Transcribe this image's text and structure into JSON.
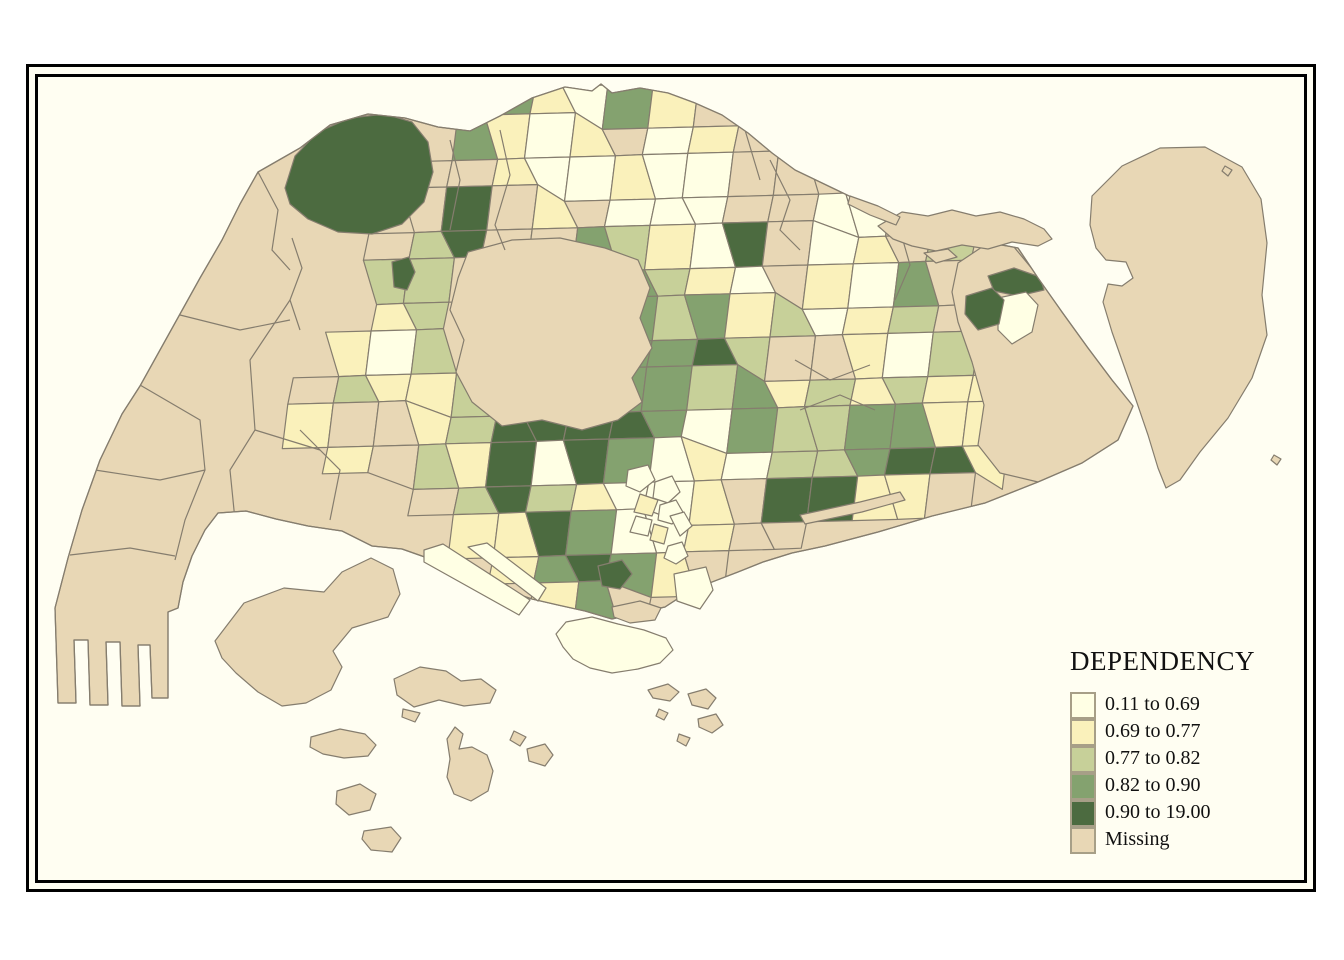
{
  "frame": {
    "page_bg": "#ffffff",
    "border_color": "#000000",
    "sea_color": "#FFFEF2"
  },
  "legend": {
    "title": "DEPENDENCY",
    "swatch_border": "#A79F87",
    "items": [
      {
        "label": "0.11 to 0.69",
        "class": "c1"
      },
      {
        "label": "0.69 to 0.77",
        "class": "c2"
      },
      {
        "label": "0.77 to 0.82",
        "class": "c3"
      },
      {
        "label": "0.82 to 0.90",
        "class": "c4"
      },
      {
        "label": "0.90 to 19.00",
        "class": "c5"
      },
      {
        "label": "Missing",
        "class": "m"
      }
    ]
  },
  "map": {
    "stroke": "#857D6E",
    "classes": {
      "c1": "#FFFFE4",
      "c2": "#FAF1BB",
      "c3": "#C7D099",
      "c4": "#84A26F",
      "c5": "#4C6B40",
      "m": "#E8D7B5"
    },
    "main_island": "258,172 300,148 330,125 368,114 405,118 438,127 470,131 500,116 532,98 565,87 592,91 601,84 612,93 640,88 668,93 695,103 722,115 748,133 772,153 795,170 820,182 845,194 872,207 900,221 932,231 962,238 992,243 1018,248 1038,278 1062,312 1088,348 1112,380 1133,406 1118,440 1082,463 1038,482 985,503 932,516 878,532 825,546 792,553 763,562 738,572 712,582 688,592 665,607 638,613 612,619 585,611 558,605 532,599 508,591 472,576 436,561 402,549 372,546 342,531 308,526 276,519 246,511 218,513 205,530 192,556 183,582 178,608 168,612 168,698 152,698 150,645 138,645 140,706 122,706 120,642 106,642 108,705 90,705 88,640 74,640 76,703 58,703 55,608 68,558 82,510 100,460 122,414 140,386 160,350 180,314 200,278 222,240 240,204",
    "grid": {
      "x0": 290,
      "y0": 85,
      "dx": 40,
      "dy": 36,
      "cells": [
        [
          5,
          0,
          "c4"
        ],
        [
          6,
          0,
          "c2"
        ],
        [
          7,
          0,
          "c1"
        ],
        [
          8,
          0,
          "c4"
        ],
        [
          9,
          0,
          "c2"
        ],
        [
          10,
          0,
          "m"
        ],
        [
          4,
          1,
          "c4"
        ],
        [
          5,
          1,
          "c2"
        ],
        [
          6,
          1,
          "c1"
        ],
        [
          7,
          1,
          "c2"
        ],
        [
          8,
          1,
          "m"
        ],
        [
          9,
          1,
          "c1"
        ],
        [
          10,
          1,
          "c2"
        ],
        [
          11,
          1,
          "m"
        ],
        [
          3,
          2,
          "m"
        ],
        [
          4,
          2,
          "m"
        ],
        [
          5,
          2,
          "c2"
        ],
        [
          6,
          2,
          "c1"
        ],
        [
          7,
          2,
          "c1"
        ],
        [
          8,
          2,
          "c2"
        ],
        [
          9,
          2,
          "c1"
        ],
        [
          10,
          2,
          "c1"
        ],
        [
          11,
          2,
          "m"
        ],
        [
          12,
          2,
          "m"
        ],
        [
          3,
          3,
          "m"
        ],
        [
          4,
          3,
          "c5"
        ],
        [
          5,
          3,
          "m"
        ],
        [
          6,
          3,
          "c2"
        ],
        [
          7,
          3,
          "m"
        ],
        [
          8,
          3,
          "c1"
        ],
        [
          9,
          3,
          "c1"
        ],
        [
          10,
          3,
          "c1"
        ],
        [
          11,
          3,
          "m"
        ],
        [
          12,
          3,
          "m"
        ],
        [
          13,
          3,
          "c1"
        ],
        [
          14,
          3,
          "c1"
        ],
        [
          15,
          3,
          "m"
        ],
        [
          2,
          4,
          "m"
        ],
        [
          3,
          4,
          "c3"
        ],
        [
          4,
          4,
          "c5"
        ],
        [
          5,
          4,
          "m"
        ],
        [
          6,
          4,
          "m"
        ],
        [
          7,
          4,
          "c4"
        ],
        [
          8,
          4,
          "c3"
        ],
        [
          9,
          4,
          "c2"
        ],
        [
          10,
          4,
          "c1"
        ],
        [
          11,
          4,
          "c5"
        ],
        [
          12,
          4,
          "m"
        ],
        [
          13,
          4,
          "c1"
        ],
        [
          14,
          4,
          "c2"
        ],
        [
          15,
          4,
          "m"
        ],
        [
          16,
          4,
          "c3"
        ],
        [
          2,
          5,
          "c3"
        ],
        [
          3,
          5,
          "c3"
        ],
        [
          4,
          5,
          "m"
        ],
        [
          7,
          5,
          "c4"
        ],
        [
          8,
          5,
          "c4"
        ],
        [
          9,
          5,
          "c3"
        ],
        [
          10,
          5,
          "c2"
        ],
        [
          11,
          5,
          "c1"
        ],
        [
          12,
          5,
          "m"
        ],
        [
          13,
          5,
          "c2"
        ],
        [
          14,
          5,
          "c1"
        ],
        [
          15,
          5,
          "c4"
        ],
        [
          16,
          5,
          "m"
        ],
        [
          2,
          6,
          "c2"
        ],
        [
          3,
          6,
          "c3"
        ],
        [
          8,
          6,
          "c4"
        ],
        [
          9,
          6,
          "c3"
        ],
        [
          10,
          6,
          "c4"
        ],
        [
          11,
          6,
          "c2"
        ],
        [
          12,
          6,
          "c3"
        ],
        [
          13,
          6,
          "c1"
        ],
        [
          14,
          6,
          "c2"
        ],
        [
          15,
          6,
          "c3"
        ],
        [
          16,
          6,
          "m"
        ],
        [
          1,
          7,
          "c2"
        ],
        [
          2,
          7,
          "c1"
        ],
        [
          3,
          7,
          "c3"
        ],
        [
          8,
          7,
          "c4"
        ],
        [
          9,
          7,
          "c4"
        ],
        [
          10,
          7,
          "c5"
        ],
        [
          11,
          7,
          "c3"
        ],
        [
          12,
          7,
          "m"
        ],
        [
          13,
          7,
          "m"
        ],
        [
          14,
          7,
          "c2"
        ],
        [
          15,
          7,
          "c1"
        ],
        [
          16,
          7,
          "c3"
        ],
        [
          0,
          8,
          "m"
        ],
        [
          1,
          8,
          "c3"
        ],
        [
          2,
          8,
          "c2"
        ],
        [
          3,
          8,
          "c2"
        ],
        [
          4,
          8,
          "c3"
        ],
        [
          7,
          8,
          "c4"
        ],
        [
          8,
          8,
          "c4"
        ],
        [
          9,
          8,
          "c4"
        ],
        [
          10,
          8,
          "c3"
        ],
        [
          11,
          8,
          "c4"
        ],
        [
          12,
          8,
          "c2"
        ],
        [
          13,
          8,
          "c3"
        ],
        [
          14,
          8,
          "c2"
        ],
        [
          15,
          8,
          "c3"
        ],
        [
          16,
          8,
          "c2"
        ],
        [
          17,
          8,
          "c2"
        ],
        [
          0,
          9,
          "c2"
        ],
        [
          1,
          9,
          "m"
        ],
        [
          2,
          9,
          "m"
        ],
        [
          3,
          9,
          "c2"
        ],
        [
          4,
          9,
          "c3"
        ],
        [
          5,
          9,
          "c5"
        ],
        [
          6,
          9,
          "c5"
        ],
        [
          7,
          9,
          "c5"
        ],
        [
          8,
          9,
          "c5"
        ],
        [
          9,
          9,
          "c4"
        ],
        [
          10,
          9,
          "c1"
        ],
        [
          11,
          9,
          "c4"
        ],
        [
          12,
          9,
          "c3"
        ],
        [
          13,
          9,
          "c3"
        ],
        [
          14,
          9,
          "c4"
        ],
        [
          15,
          9,
          "c4"
        ],
        [
          16,
          9,
          "c2"
        ],
        [
          17,
          9,
          "c2"
        ],
        [
          1,
          10,
          "c2"
        ],
        [
          2,
          10,
          "m"
        ],
        [
          3,
          10,
          "c3"
        ],
        [
          4,
          10,
          "c2"
        ],
        [
          5,
          10,
          "c5"
        ],
        [
          6,
          10,
          "c1"
        ],
        [
          7,
          10,
          "c5"
        ],
        [
          8,
          10,
          "c4"
        ],
        [
          9,
          10,
          "c1"
        ],
        [
          10,
          10,
          "c2"
        ],
        [
          11,
          10,
          "c1"
        ],
        [
          12,
          10,
          "c3"
        ],
        [
          13,
          10,
          "c3"
        ],
        [
          14,
          10,
          "c4"
        ],
        [
          15,
          10,
          "c5"
        ],
        [
          16,
          10,
          "c5"
        ],
        [
          17,
          10,
          "c2"
        ],
        [
          3,
          11,
          "m"
        ],
        [
          4,
          11,
          "c3"
        ],
        [
          5,
          11,
          "c5"
        ],
        [
          6,
          11,
          "c3"
        ],
        [
          7,
          11,
          "c2"
        ],
        [
          8,
          11,
          "c1"
        ],
        [
          9,
          11,
          "c1"
        ],
        [
          10,
          11,
          "c2"
        ],
        [
          11,
          11,
          "m"
        ],
        [
          12,
          11,
          "c5"
        ],
        [
          13,
          11,
          "c5"
        ],
        [
          14,
          11,
          "c2"
        ],
        [
          15,
          11,
          "c2"
        ],
        [
          16,
          11,
          "m"
        ],
        [
          4,
          12,
          "c2"
        ],
        [
          5,
          12,
          "c2"
        ],
        [
          6,
          12,
          "c5"
        ],
        [
          7,
          12,
          "c4"
        ],
        [
          8,
          12,
          "c1"
        ],
        [
          9,
          12,
          "c1"
        ],
        [
          10,
          12,
          "c2"
        ],
        [
          11,
          12,
          "m"
        ],
        [
          12,
          12,
          "m"
        ],
        [
          5,
          13,
          "c2"
        ],
        [
          6,
          13,
          "c4"
        ],
        [
          7,
          13,
          "c5"
        ],
        [
          8,
          13,
          "c4"
        ],
        [
          9,
          13,
          "c2"
        ],
        [
          10,
          13,
          "m"
        ],
        [
          6,
          14,
          "c2"
        ],
        [
          7,
          14,
          "c4"
        ],
        [
          8,
          14,
          "m"
        ]
      ]
    },
    "bigzones": [
      {
        "name": "western-catchment",
        "class": "c5",
        "points": "285,188 295,156 318,132 350,118 385,114 412,122 428,142 433,172 424,202 402,224 372,234 338,232 308,219 290,204"
      },
      {
        "name": "central-catchment",
        "class": "m",
        "points": "468,252 512,240 560,238 605,248 638,260 650,288 640,318 652,348 632,378 642,402 618,420 582,430 542,420 502,426 472,402 456,372 464,340 450,310 458,278"
      },
      {
        "name": "changi",
        "class": "m",
        "points": "988,243 1014,247 1038,276 1062,312 1088,348 1112,380 1134,406 1118,440 1082,463 1038,482 1000,473 978,445 984,405 972,362 958,322 952,292 958,263"
      }
    ],
    "details": [
      {
        "name": "changi-dark-sliver",
        "class": "c5",
        "points": "988,276 1014,268 1040,277 1044,290 1018,296 994,291"
      },
      {
        "name": "changi-white",
        "class": "c1",
        "points": "998,298 1026,292 1038,305 1032,332 1012,344 998,330"
      },
      {
        "name": "pasir-ris-dark",
        "class": "c5",
        "points": "966,296 992,288 1004,300 999,324 978,330 965,314"
      },
      {
        "name": "mandai-dark-sliver",
        "class": "c5",
        "points": "392,262 409,257 415,272 407,290 394,287"
      },
      {
        "name": "cbd-sub-1",
        "class": "c1",
        "points": "628,470 648,465 655,480 640,492 626,486"
      },
      {
        "name": "cbd-sub-2",
        "class": "c1",
        "points": "655,482 672,476 680,492 668,503 653,498"
      },
      {
        "name": "cbd-sub-3",
        "class": "c2",
        "points": "640,494 658,500 652,516 634,512"
      },
      {
        "name": "cbd-sub-4",
        "class": "c1",
        "points": "660,505 676,500 684,514 672,524 658,520"
      },
      {
        "name": "cbd-sub-5",
        "class": "c1",
        "points": "636,516 652,520 648,536 630,532"
      },
      {
        "name": "cbd-sub-6",
        "class": "c2",
        "points": "654,524 668,528 664,544 650,540"
      },
      {
        "name": "cbd-sub-7",
        "class": "c1",
        "points": "670,516 684,512 692,526 680,536"
      },
      {
        "name": "cbd-sub-8",
        "class": "c1",
        "points": "668,546 682,542 688,556 676,564 664,558"
      },
      {
        "name": "telok-blangah-dark",
        "class": "c5",
        "points": "598,566 622,560 632,574 620,589 602,586"
      },
      {
        "name": "marine-parade-tan",
        "class": "m",
        "points": "800,515 860,502 900,492 905,500 862,512 805,524"
      }
    ],
    "lines": [
      "140,385 200,420 205,470 185,520 175,560",
      "95,470 160,480 205,470",
      "70,555 130,548 175,556",
      "258,172 278,210 272,250 290,270",
      "292,238 302,268 290,300 300,330",
      "290,300 250,360 255,430 230,470 235,520",
      "180,315 240,330 290,320",
      "300,430 340,470 330,520",
      "255,430 320,450",
      "450,140 460,180 450,230",
      "500,130 510,175 495,225 505,250",
      "770,160 790,200 780,230 800,250",
      "745,130 760,180",
      "900,230 910,265 895,300",
      "795,360 830,380 870,365",
      "800,410 840,395 875,410"
    ],
    "islands": [
      {
        "name": "pulau-tekong",
        "class": "m",
        "points": "1092,196 1122,166 1160,148 1205,147 1242,167 1261,199 1267,243 1262,295 1267,335 1252,378 1228,418 1200,452 1180,480 1166,488 1158,468 1148,435 1136,400 1124,366 1112,332 1103,302 1108,284 1122,286 1133,278 1126,262 1106,260 1096,248 1090,225"
      },
      {
        "name": "pulau-ubin",
        "class": "m",
        "points": "878,226 902,212 928,216 952,210 976,216 1000,212 1024,219 1044,229 1052,239 1038,246 1012,242 988,249 962,245 936,251 912,246 893,239"
      },
      {
        "name": "ubin-islet",
        "class": "m",
        "points": "924,253 948,249 957,257 936,263"
      },
      {
        "name": "coney-island",
        "class": "m",
        "points": "850,196 878,206 900,217 896,225 870,215 848,204"
      },
      {
        "name": "sentosa",
        "class": "c1",
        "points": "566,622 592,617 618,624 644,630 666,638 673,650 660,663 638,669 612,673 590,668 573,659 563,647 556,634"
      },
      {
        "name": "pulau-brani",
        "class": "m",
        "points": "612,607 640,601 661,608 655,620 630,623 614,617"
      },
      {
        "name": "pulau-bukom",
        "class": "m",
        "points": "394,679 420,667 446,671 461,681 481,679 496,690 490,703 464,706 439,700 414,707 397,695"
      },
      {
        "name": "bukom-islet",
        "class": "m",
        "points": "403,709 420,713 415,722 402,717"
      },
      {
        "name": "pulau-semakau",
        "class": "m",
        "points": "447,739 455,727 463,734 459,749 472,747 487,755 493,771 488,791 471,801 454,794 447,777 450,759"
      },
      {
        "name": "pulau-jong",
        "class": "m",
        "points": "514,731 526,737 520,746 510,740"
      },
      {
        "name": "pulau-sebarok",
        "class": "m",
        "points": "527,749 545,744 553,755 545,766 529,761"
      },
      {
        "name": "pulau-sudong",
        "class": "m",
        "points": "311,737 340,729 365,734 376,745 368,756 344,758 323,754 310,747"
      },
      {
        "name": "pulau-pawai",
        "class": "m",
        "points": "337,791 360,784 376,794 370,810 349,815 336,804"
      },
      {
        "name": "pulau-senang",
        "class": "m",
        "points": "364,831 391,827 401,838 392,852 371,850 362,839"
      },
      {
        "name": "st-johns-island",
        "class": "m",
        "points": "648,690 668,684 679,692 670,701 653,698"
      },
      {
        "name": "lazarus-island",
        "class": "m",
        "points": "688,694 706,689 716,698 708,709 692,705"
      },
      {
        "name": "kusu-island",
        "class": "m",
        "points": "698,719 716,714 723,725 712,733 699,727"
      },
      {
        "name": "islet-south-1",
        "class": "m",
        "points": "659,709 668,713 664,720 656,716"
      },
      {
        "name": "islet-south-2",
        "class": "m",
        "points": "679,734 690,738 686,746 677,741"
      },
      {
        "name": "tekong-islet",
        "class": "m",
        "points": "1225,166 1232,170 1228,176 1222,171"
      },
      {
        "name": "changi-islet",
        "class": "m",
        "points": "1274,455 1281,459 1277,465 1271,460"
      },
      {
        "name": "jurong-island",
        "class": "m",
        "points": "215,641 244,603 284,588 324,592 342,572 371,558 393,569 400,594 388,617 352,628 333,651 342,667 331,690 306,703 282,706 258,692 236,673 222,658"
      }
    ],
    "piers": [
      {
        "name": "pasir-panjang-pier-1",
        "class": "c1",
        "points": "424,550 443,544 530,600 519,615 424,562"
      },
      {
        "name": "pasir-panjang-pier-2",
        "class": "c1",
        "points": "468,547 487,543 546,588 538,601"
      },
      {
        "name": "marina-south",
        "class": "c1",
        "points": "674,574 706,567 713,590 700,609 677,601"
      }
    ]
  }
}
